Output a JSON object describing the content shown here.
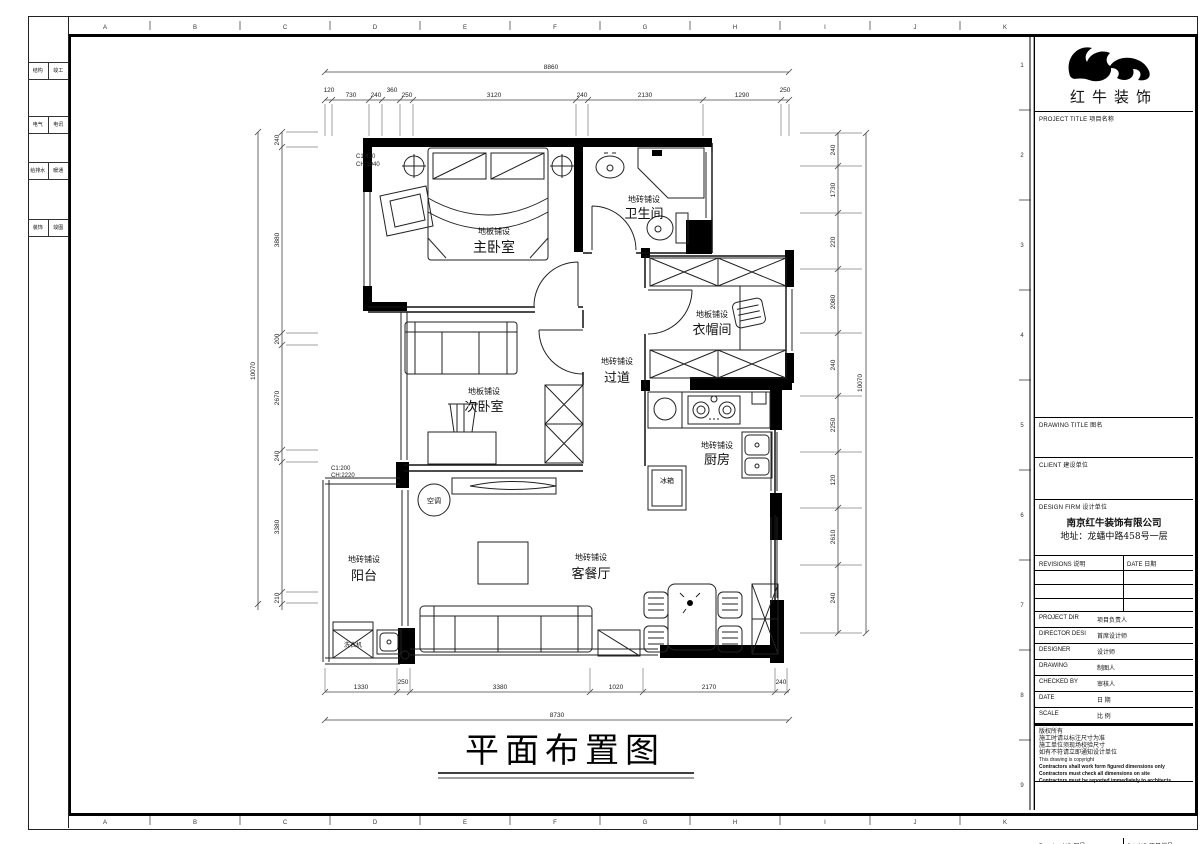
{
  "sheet": {
    "plan_title": "平面布置图"
  },
  "grid": {
    "columns": [
      "A",
      "B",
      "C",
      "D",
      "E",
      "F",
      "G",
      "H",
      "I",
      "J",
      "K"
    ],
    "rows": [
      "1",
      "2",
      "3",
      "4",
      "5",
      "6",
      "7",
      "8",
      "9"
    ]
  },
  "side_strip": {
    "rows": [
      [
        "结构",
        "竣工"
      ],
      [
        "电气",
        "电讯"
      ],
      [
        "给排水",
        "暖通"
      ],
      [
        "装饰",
        "竣图"
      ]
    ]
  },
  "rooms": {
    "master_bedroom": {
      "name": "主卧室",
      "finish": "地板铺设"
    },
    "bathroom": {
      "name": "卫生间",
      "finish": "地砖铺设"
    },
    "cloakroom": {
      "name": "衣帽间",
      "finish": "地板铺设"
    },
    "corridor": {
      "name": "过道",
      "finish": "地砖铺设"
    },
    "second_bedroom": {
      "name": "次卧室",
      "finish": "地板铺设"
    },
    "kitchen": {
      "name": "厨房",
      "finish": "地砖铺设"
    },
    "living_dining": {
      "name": "客餐厅",
      "finish": "地砖铺设"
    },
    "balcony": {
      "name": "阳台",
      "finish": "地砖铺设"
    }
  },
  "appliances": {
    "ac": "空调",
    "washing_machine": "洗衣机",
    "fridge": "冰箱"
  },
  "window_marks": {
    "master_line1": "C1:430",
    "master_line2": "CH:1940",
    "balcony_line1": "C1:200",
    "balcony_line2": "CH:2220"
  },
  "dims": {
    "top_total": "8860",
    "top": [
      "120",
      "730",
      "240",
      "360",
      "250",
      "3120",
      "240",
      "2130",
      "1290",
      "250"
    ],
    "bottom": [
      "1330",
      "250",
      "3380",
      "1020",
      "2170",
      "240"
    ],
    "bottom_total": "8730",
    "left": [
      "240",
      "3880",
      "200",
      "2670",
      "240",
      "3380",
      "210"
    ],
    "left_total": "10070",
    "right": [
      "240",
      "1730",
      "220",
      "2080",
      "240",
      "2250",
      "120",
      "2610",
      "240"
    ],
    "right_total": "10070"
  },
  "title_block": {
    "logo_text": "红牛装饰",
    "project_title_label": "PROJECT TITLE 项目名称",
    "drawing_title_label": "DRAWING TITLE 图名",
    "client_label": "CLIENT 建设单位",
    "design_firm_label": "DESIGN FIRM 设计单位",
    "firm_name": "南京红牛装饰有限公司",
    "firm_address": "地址：龙蟠中路458号一层",
    "revisions_label": "REVISIONS 说明",
    "date_col_label": "DATE 日期",
    "staff": [
      {
        "en": "PROJECT DIR",
        "zh": "项目负责人"
      },
      {
        "en": "DIRECTOR DESI",
        "zh": "首席设计师"
      },
      {
        "en": "DESIGNER",
        "zh": "设计师"
      },
      {
        "en": "DRAWING",
        "zh": "制图人"
      },
      {
        "en": "CHECKED BY",
        "zh": "审核人"
      },
      {
        "en": "DATE",
        "zh": "日  期"
      },
      {
        "en": "SCALE",
        "zh": "比  例"
      }
    ],
    "notes": [
      "版权所有",
      "施工时请以标注尺寸为准",
      "施工单位须现场校验尺寸",
      "如有不符请立即通知设计单位",
      "This drawing is copyright",
      "Contractors shall work form figured dimensions only",
      "Contractors must check all dimensions on site",
      "Contractors must be reported immediately to architects"
    ],
    "drawing_no_label": "Drawing NO 图号",
    "job_no_label": "Job NO 项目编号"
  }
}
